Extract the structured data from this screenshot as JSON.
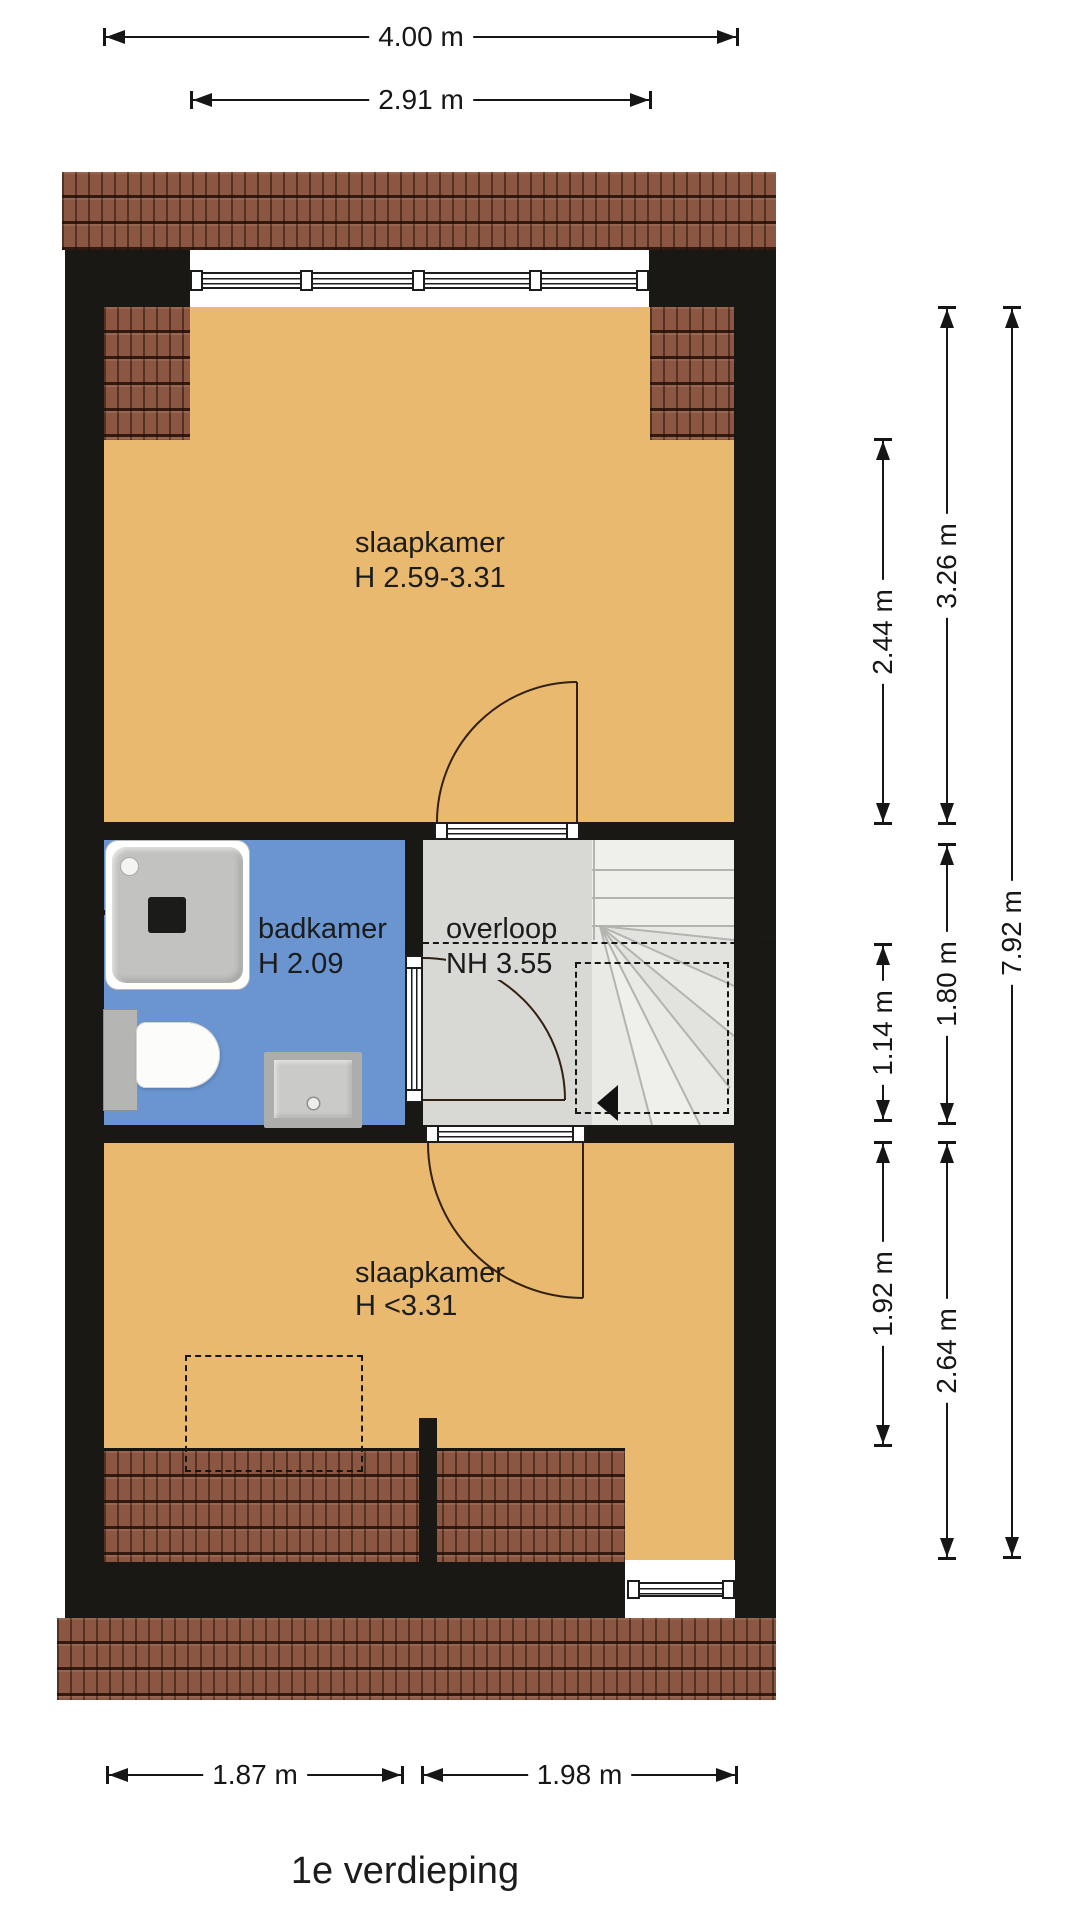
{
  "title": "1e verdieping",
  "colors": {
    "wall": "#191815",
    "floor": "#E8B96E",
    "bathroom": "#6A95D1",
    "landing": "#D8D8D5",
    "stairs": "#E9E9E6",
    "roof": "#8B5742",
    "line": "#161616",
    "window": "#FFFFFF"
  },
  "rooms": {
    "bedroom_top": {
      "label": "slaapkamer",
      "height": "H 2.59-3.31"
    },
    "bathroom": {
      "label": "badkamer",
      "height": "H 2.09"
    },
    "landing": {
      "label": "overloop",
      "height": "NH 3.55"
    },
    "bedroom_bottom": {
      "label": "slaapkamer",
      "height": "H <3.31"
    }
  },
  "dimensions": {
    "width_total": "4.00 m",
    "width_inner": "2.91 m",
    "top_room_partial": "2.44 m",
    "top_room": "3.26 m",
    "middle": "1.80 m",
    "stair_opening": "1.14 m",
    "bottom_room_partial": "1.92 m",
    "bottom_room": "2.64 m",
    "depth_total": "7.92 m",
    "bottom_left": "1.87 m",
    "bottom_right": "1.98 m"
  }
}
